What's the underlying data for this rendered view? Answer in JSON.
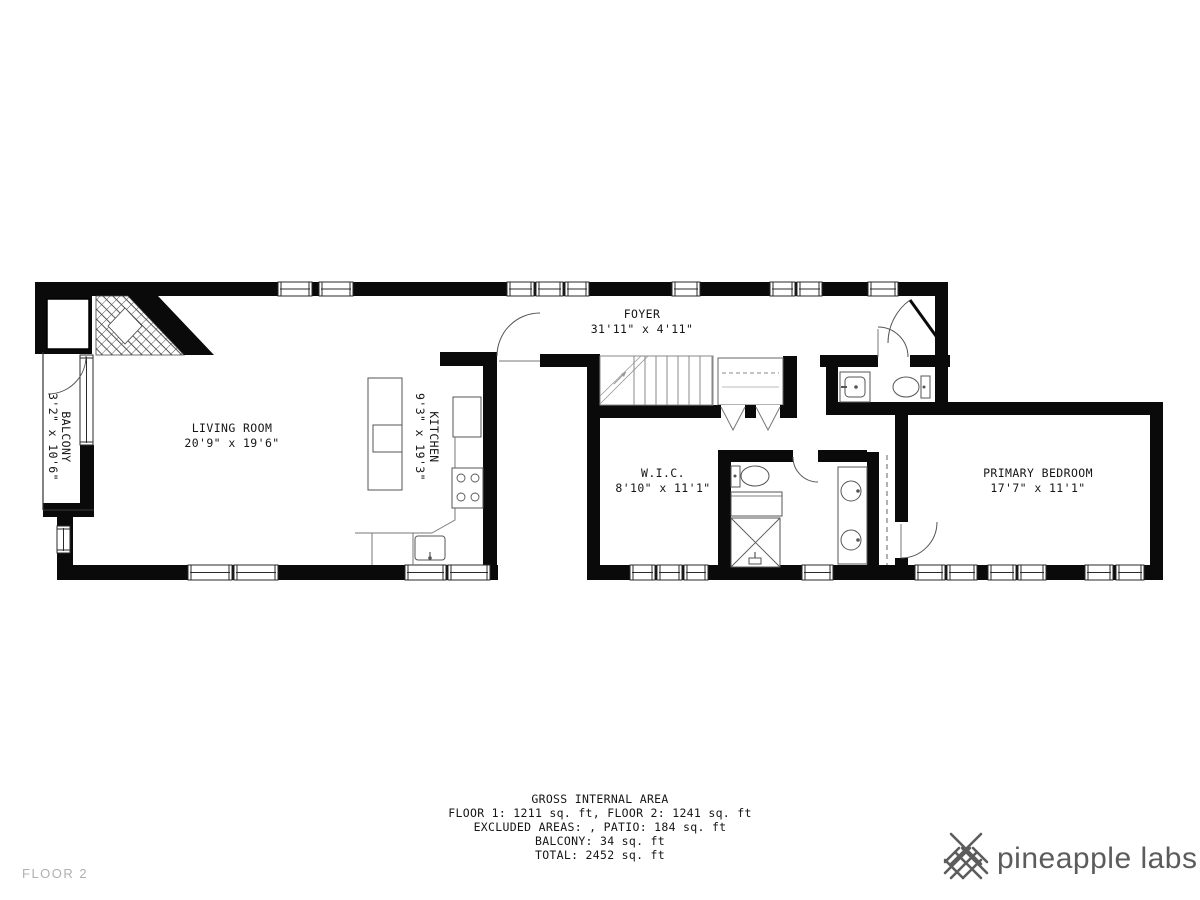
{
  "meta": {
    "floor_label": "FLOOR 2"
  },
  "brand": {
    "name": "pineapple labs"
  },
  "rooms": {
    "foyer": {
      "name": "FOYER",
      "dims": "31'11\" x 4'11\""
    },
    "living_room": {
      "name": "LIVING ROOM",
      "dims": "20'9\" x 19'6\""
    },
    "kitchen": {
      "name": "KITCHEN",
      "dims": "9'3\" x 19'3\""
    },
    "balcony": {
      "name": "BALCONY",
      "dims": "3'2\" x 10'6\""
    },
    "wic": {
      "name": "W.I.C.",
      "dims": "8'10\" x 11'1\""
    },
    "primary_bedroom": {
      "name": "PRIMARY BEDROOM",
      "dims": "17'7\" x 11'1\""
    }
  },
  "area_summary": {
    "title": "GROSS INTERNAL AREA",
    "floors": "FLOOR 1: 1211 sq. ft, FLOOR 2: 1241 sq. ft",
    "excluded": "EXCLUDED AREAS: , PATIO: 184 sq. ft",
    "balcony": "BALCONY: 34 sq. ft",
    "total": "TOTAL: 2452 sq. ft"
  },
  "colors": {
    "wall": "#0a0a0a",
    "brand_gray": "#5c5c5c",
    "floor_label_gray": "#b0b0b0"
  }
}
